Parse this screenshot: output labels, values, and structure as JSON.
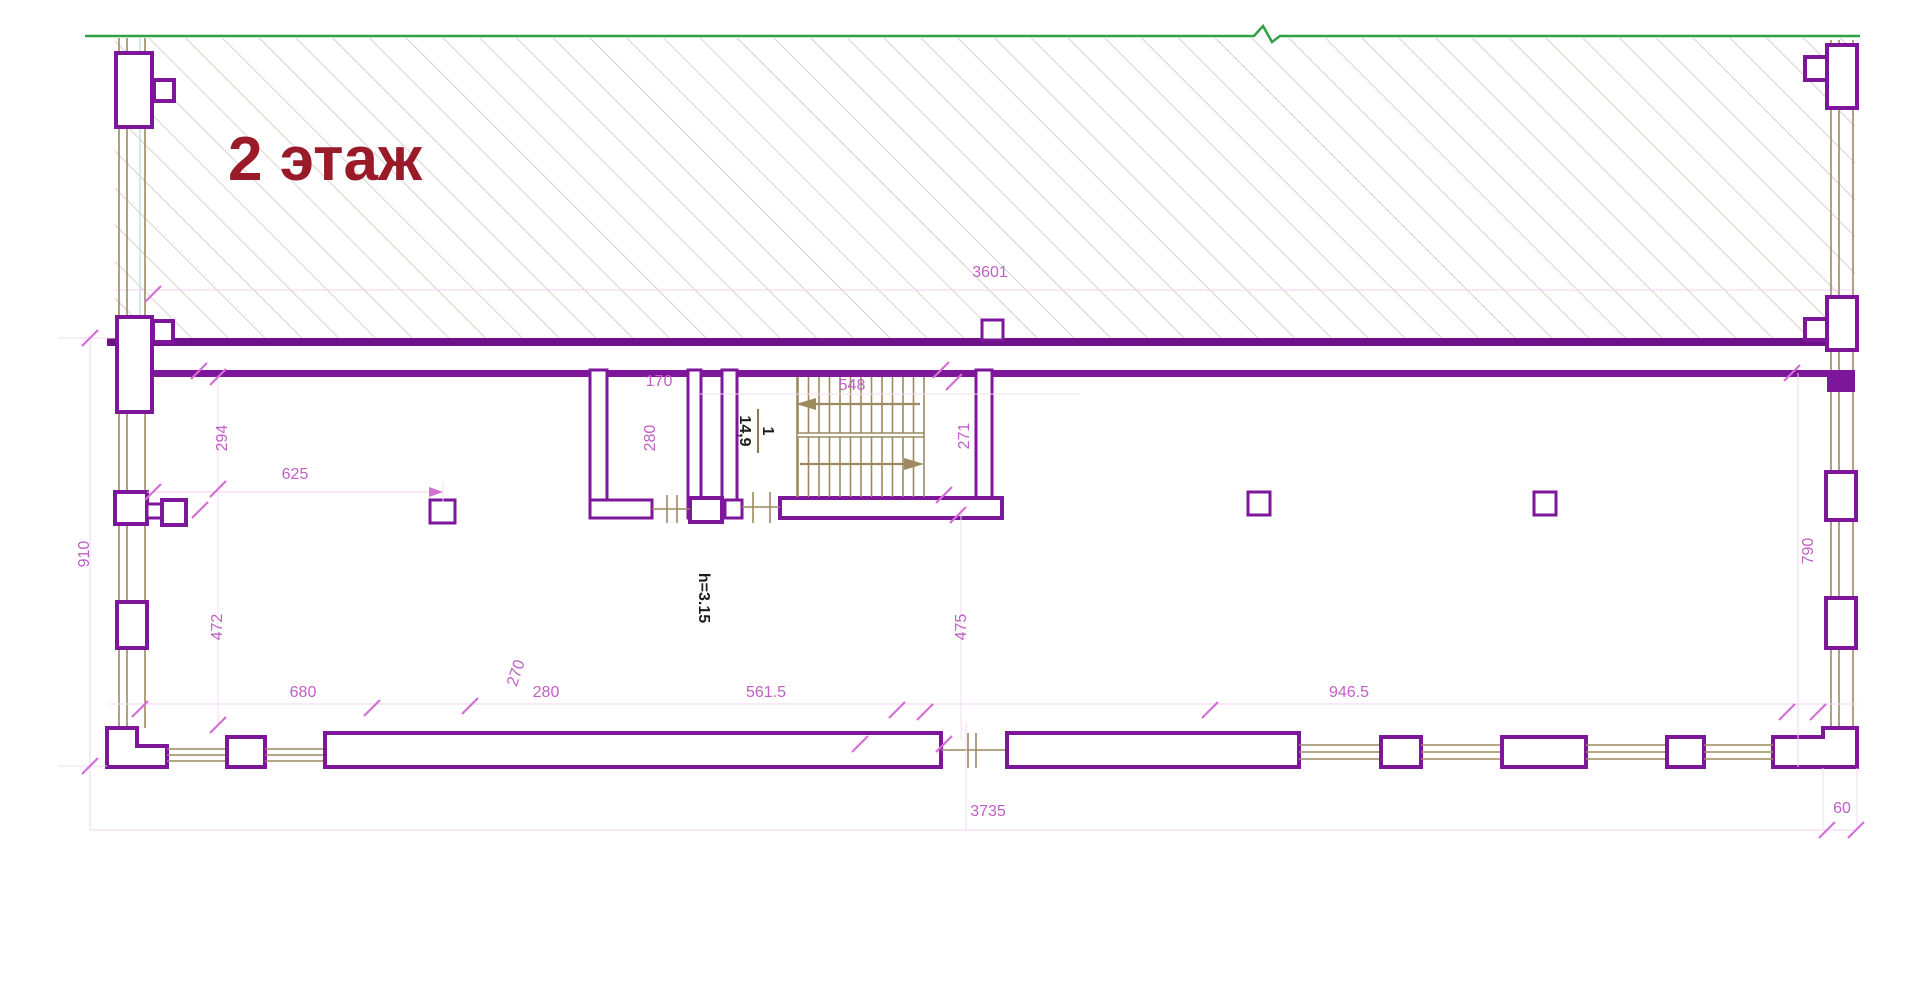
{
  "plan": {
    "title": "2 этаж",
    "stair_label": {
      "number": "1",
      "area": "14,9"
    },
    "height_note": "h=3.15",
    "dims": {
      "strip": "3601",
      "left_total": "910",
      "left_upper": "294",
      "left_lower": "472",
      "hall": "625",
      "room_width": "170",
      "room_depth": "280",
      "stair_width": "548",
      "stair_height": "271",
      "below_stair": "475",
      "right_side": "790",
      "bottom_a": "680",
      "bottom_b": "270",
      "bottom_c": "280",
      "bottom_d": "561.5",
      "bottom_e": "946.5",
      "bottom_total": "3735",
      "bottom_corner": "60"
    },
    "colors": {
      "wall_purple": "#7e169c",
      "solid_wall_purple": "#6d1189",
      "dimension_magenta": "#c05fc5",
      "window_tan": "#9c8a60",
      "boundary_green": "#2fa043",
      "title_red": "#991a29",
      "hatch_gray": "#c6beb4"
    }
  }
}
